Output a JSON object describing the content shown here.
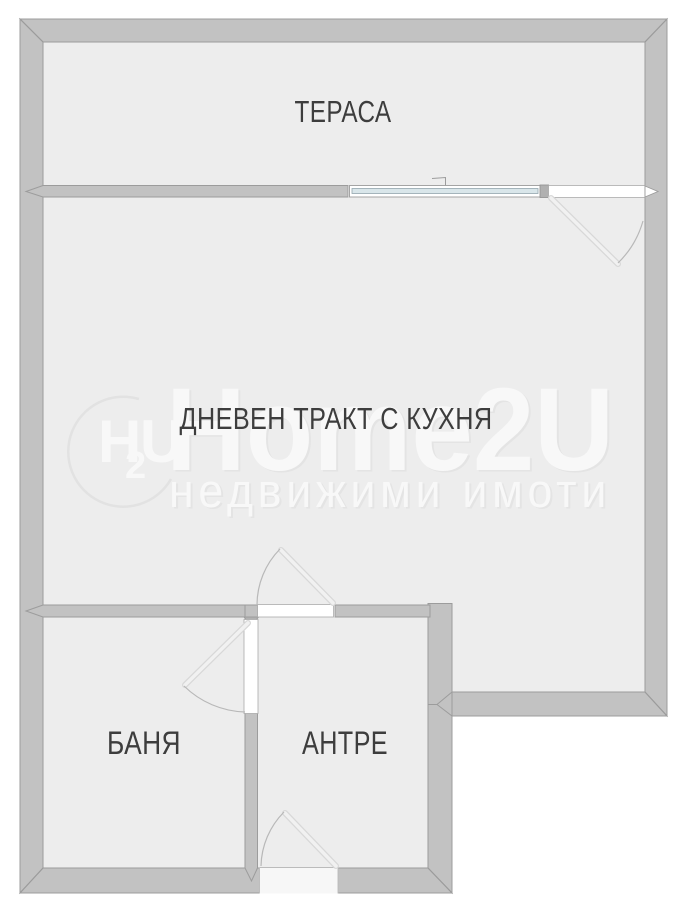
{
  "floorplan": {
    "rooms": [
      {
        "id": "terrace",
        "label": "ТЕРАСА"
      },
      {
        "id": "living",
        "label": "ДНЕВЕН ТРАКТ С КУХНЯ"
      },
      {
        "id": "bath",
        "label": "БАНЯ"
      },
      {
        "id": "hall",
        "label": "АНТРЕ"
      }
    ],
    "watermark": {
      "logo_h": "H",
      "logo_sub": "2",
      "logo_u": "U",
      "brand": "Home2U",
      "tagline": "недвижими имоти"
    },
    "colors": {
      "background": "#ffffff",
      "wall": "#c2c2c2",
      "wall_outline": "#9c9c9c",
      "floor": "#ededed",
      "glass": "#d9e6ea",
      "door_leaf": "#e8e8e8",
      "arc": "#b8b8b8",
      "label": "#3d3d3d",
      "watermark": "#f8f8f8"
    }
  }
}
